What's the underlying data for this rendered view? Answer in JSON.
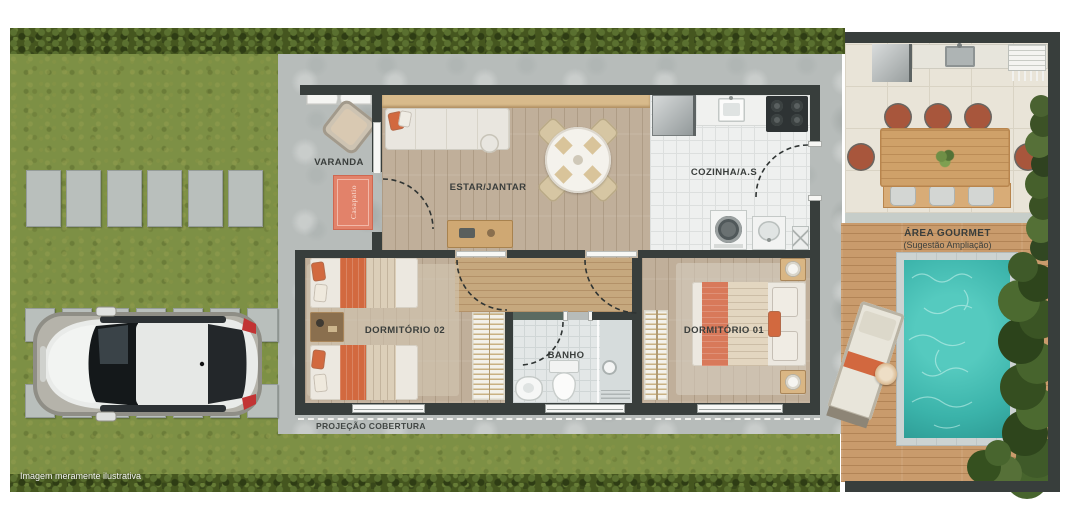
{
  "labels": {
    "varanda": "VARANDA",
    "estar": "ESTAR/JANTAR",
    "cozinha": "COZINHA/A.S",
    "dorm02": "DORMITÓRIO 02",
    "dorm01": "DORMITÓRIO 01",
    "banho": "BANHO",
    "projecao": "PROJEÇÃO COBERTURA",
    "gourmet_title": "ÁREA GOURMET",
    "gourmet_sub": "(Sugestão Ampliação)",
    "doormat": "Casapatio",
    "disclaimer": "Imagem meramente ilustrativa"
  },
  "colors": {
    "wall": "#383e3c",
    "grass": "#7d9045",
    "concrete": "#b7bcba",
    "wood_floor": "#c0af9a",
    "deck": "#c99b6c",
    "pool": "#3fbcb2",
    "accent_coral": "#d2693f",
    "accent_teal_wall": "#5a6a61"
  },
  "icons": {
    "pool": "pool-water",
    "car": "car-top-view"
  }
}
